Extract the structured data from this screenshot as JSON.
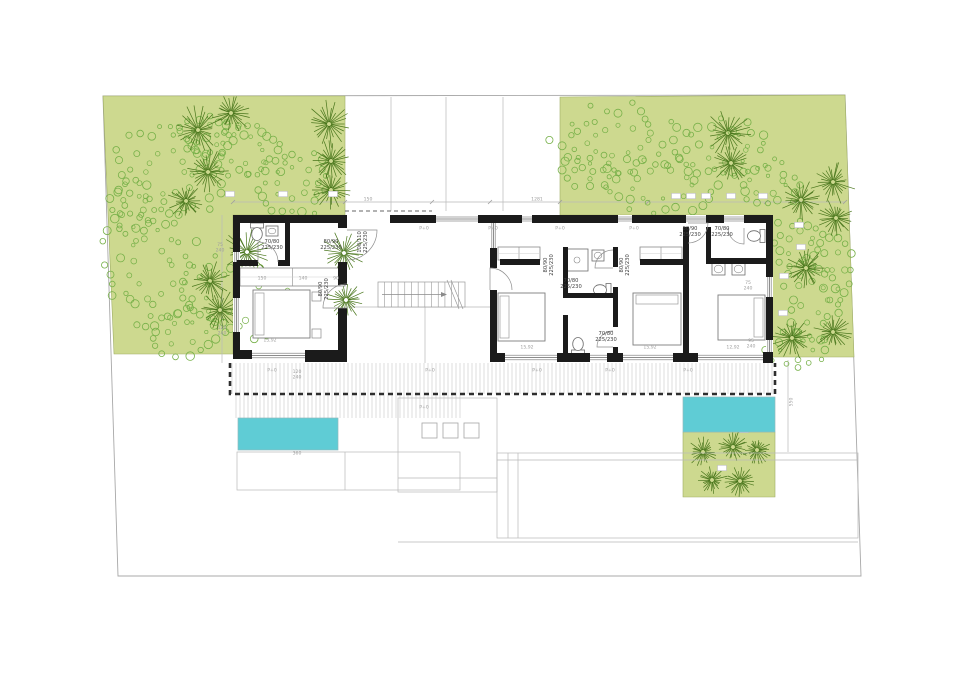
{
  "title": "villa-ground-floor-plan",
  "canvas": {
    "w": 960,
    "h": 679,
    "bg": "#ffffff"
  },
  "colors": {
    "garden": "#cdd98f",
    "shrub": "#76b048",
    "palm": "#49761c",
    "pool": "#5fccd5",
    "wall": "#1b1b1b",
    "thin": "#b9b9b9",
    "hatch": "#c6c6c6",
    "dash": "#2e2e2e",
    "furn": "#8a8a8a",
    "dim": "#9e9e9e",
    "label": "#3f3f3f",
    "boundary": "#a8a8a8"
  },
  "plan": {
    "boundary": [
      [
        103,
        96
      ],
      [
        845,
        95
      ],
      [
        861,
        576
      ],
      [
        118,
        576
      ]
    ],
    "gardens": {
      "left": [
        [
          103,
          96
        ],
        [
          345,
          96
        ],
        [
          345,
          215
        ],
        [
          233,
          215
        ],
        [
          233,
          354
        ],
        [
          114,
          354
        ]
      ],
      "right": [
        [
          560,
          97
        ],
        [
          845,
          95
        ],
        [
          854,
          357
        ],
        [
          770,
          357
        ],
        [
          770,
          215
        ],
        [
          560,
          215
        ]
      ],
      "patch": [
        [
          683,
          432
        ],
        [
          775,
          432
        ],
        [
          775,
          497
        ],
        [
          683,
          497
        ]
      ]
    },
    "pools": [
      {
        "x": 238,
        "y": 418,
        "w": 100,
        "h": 32
      },
      {
        "x": 683,
        "y": 397,
        "w": 92,
        "h": 35
      }
    ],
    "deck": {
      "strips": [
        {
          "x": 232,
          "y": 363,
          "w": 543,
          "h": 31
        },
        {
          "x": 236,
          "y": 394,
          "w": 224,
          "h": 24
        }
      ],
      "border": "M230,363 L230,394 L775,394 L775,363"
    },
    "palms": [
      [
        198,
        130,
        26
      ],
      [
        231,
        113,
        21
      ],
      [
        329,
        124,
        25
      ],
      [
        208,
        172,
        23
      ],
      [
        331,
        161,
        21
      ],
      [
        331,
        190,
        20
      ],
      [
        186,
        201,
        19
      ],
      [
        247,
        252,
        26
      ],
      [
        344,
        253,
        23
      ],
      [
        210,
        281,
        21
      ],
      [
        220,
        310,
        22
      ],
      [
        346,
        300,
        20
      ],
      [
        728,
        133,
        24
      ],
      [
        731,
        163,
        21
      ],
      [
        833,
        182,
        23
      ],
      [
        801,
        200,
        21
      ],
      [
        836,
        218,
        20
      ],
      [
        806,
        268,
        21
      ],
      [
        792,
        338,
        22
      ],
      [
        833,
        332,
        20
      ],
      [
        703,
        452,
        16
      ],
      [
        733,
        447,
        17
      ],
      [
        757,
        450,
        15
      ],
      [
        712,
        480,
        16
      ],
      [
        740,
        481,
        16
      ]
    ],
    "shrubs": [
      [
        165,
        175,
        48,
        40,
        34
      ],
      [
        243,
        150,
        40,
        26,
        26
      ],
      [
        292,
        183,
        36,
        28,
        24
      ],
      [
        210,
        135,
        30,
        18,
        16
      ],
      [
        150,
        265,
        40,
        52,
        34
      ],
      [
        235,
        298,
        52,
        36,
        30
      ],
      [
        183,
        332,
        34,
        20,
        18
      ],
      [
        130,
        210,
        22,
        26,
        14
      ],
      [
        618,
        140,
        58,
        30,
        32
      ],
      [
        728,
        150,
        40,
        26,
        22
      ],
      [
        660,
        185,
        48,
        26,
        26
      ],
      [
        768,
        185,
        30,
        20,
        16
      ],
      [
        590,
        170,
        26,
        16,
        12
      ],
      [
        800,
        243,
        26,
        24,
        16
      ],
      [
        812,
        300,
        24,
        36,
        20
      ],
      [
        798,
        350,
        26,
        18,
        12
      ],
      [
        838,
        270,
        14,
        30,
        12
      ]
    ],
    "chips": [
      [
        230,
        194
      ],
      [
        283,
        194
      ],
      [
        333,
        194
      ],
      [
        676,
        196
      ],
      [
        691,
        196
      ],
      [
        706,
        196
      ],
      [
        731,
        196
      ],
      [
        763,
        196
      ],
      [
        799,
        225
      ],
      [
        801,
        247
      ],
      [
        784,
        276
      ],
      [
        783,
        313
      ],
      [
        744,
        430
      ],
      [
        722,
        468
      ]
    ],
    "thin": [
      [
        391,
        97,
        391,
        211
      ],
      [
        446,
        97,
        446,
        211
      ],
      [
        503,
        97,
        503,
        211
      ],
      [
        233,
        202,
        845,
        202
      ],
      [
        347,
        307,
        490,
        307
      ],
      [
        425,
        307,
        425,
        363
      ],
      [
        222,
        215,
        222,
        363
      ],
      [
        788,
        360,
        788,
        452
      ]
    ],
    "dashed_thin": [
      [
        345,
        211,
        432,
        211
      ]
    ],
    "outlines": [
      {
        "x": 237,
        "y": 452,
        "w": 223,
        "h": 38
      },
      {
        "x": 398,
        "y": 398,
        "w": 99,
        "h": 94
      },
      {
        "x": 497,
        "y": 453,
        "w": 361,
        "h": 85
      }
    ],
    "outline_lines": [
      [
        345,
        452,
        345,
        490
      ],
      [
        398,
        478,
        497,
        478
      ],
      [
        497,
        460,
        858,
        460
      ],
      [
        508,
        453,
        508,
        538
      ],
      [
        518,
        453,
        518,
        538
      ],
      [
        398,
        542,
        858,
        542
      ]
    ],
    "squares": [
      [
        422,
        423,
        15,
        15
      ],
      [
        443,
        423,
        15,
        15
      ],
      [
        464,
        423,
        15,
        15
      ]
    ],
    "walls": [
      [
        233,
        215,
        112,
        8
      ],
      [
        233,
        223,
        7,
        29
      ],
      [
        233,
        262,
        7,
        36
      ],
      [
        233,
        332,
        7,
        24
      ],
      [
        233,
        350,
        19,
        9
      ],
      [
        305,
        350,
        42,
        12
      ],
      [
        338,
        215,
        9,
        13
      ],
      [
        338,
        262,
        9,
        23
      ],
      [
        338,
        308,
        9,
        42
      ],
      [
        390,
        215,
        46,
        8
      ],
      [
        478,
        215,
        44,
        8
      ],
      [
        532,
        215,
        86,
        8
      ],
      [
        632,
        215,
        54,
        8
      ],
      [
        706,
        215,
        18,
        8
      ],
      [
        744,
        215,
        29,
        8
      ],
      [
        490,
        248,
        7,
        20
      ],
      [
        490,
        290,
        7,
        63
      ],
      [
        766,
        215,
        7,
        62
      ],
      [
        766,
        297,
        7,
        43
      ],
      [
        763,
        352,
        10,
        11
      ],
      [
        490,
        353,
        15,
        9
      ],
      [
        557,
        353,
        33,
        9
      ],
      [
        607,
        353,
        16,
        9
      ],
      [
        673,
        353,
        25,
        9
      ],
      [
        563,
        247,
        5,
        50
      ],
      [
        563,
        315,
        5,
        38
      ],
      [
        613,
        247,
        5,
        20
      ],
      [
        613,
        287,
        5,
        40
      ],
      [
        613,
        347,
        5,
        6
      ],
      [
        563,
        293,
        55,
        5
      ],
      [
        683,
        227,
        6,
        126
      ],
      [
        706,
        258,
        60,
        6
      ],
      [
        706,
        227,
        5,
        31
      ],
      [
        500,
        259,
        40,
        6
      ],
      [
        640,
        259,
        43,
        6
      ],
      [
        237,
        260,
        21,
        6
      ],
      [
        278,
        260,
        12,
        6
      ],
      [
        285,
        222,
        5,
        38
      ]
    ],
    "windows": [
      {
        "x": 233,
        "y": 252,
        "w": 7,
        "h": 10,
        "o": "v"
      },
      {
        "x": 233,
        "y": 298,
        "w": 7,
        "h": 34,
        "o": "v"
      },
      {
        "x": 490,
        "y": 223,
        "w": 7,
        "h": 25,
        "o": "v"
      },
      {
        "x": 766,
        "y": 277,
        "w": 7,
        "h": 20,
        "o": "v"
      },
      {
        "x": 766,
        "y": 340,
        "w": 7,
        "h": 12,
        "o": "v"
      },
      {
        "x": 436,
        "y": 215,
        "w": 42,
        "h": 8,
        "o": "h"
      },
      {
        "x": 522,
        "y": 215,
        "w": 10,
        "h": 8,
        "o": "h"
      },
      {
        "x": 618,
        "y": 215,
        "w": 14,
        "h": 8,
        "o": "h"
      },
      {
        "x": 686,
        "y": 215,
        "w": 20,
        "h": 8,
        "o": "h"
      },
      {
        "x": 724,
        "y": 215,
        "w": 20,
        "h": 8,
        "o": "h"
      },
      {
        "x": 505,
        "y": 353,
        "w": 52,
        "h": 9,
        "o": "h"
      },
      {
        "x": 590,
        "y": 353,
        "w": 17,
        "h": 9,
        "o": "h"
      },
      {
        "x": 623,
        "y": 353,
        "w": 50,
        "h": 9,
        "o": "h"
      },
      {
        "x": 698,
        "y": 353,
        "w": 65,
        "h": 9,
        "o": "h"
      },
      {
        "x": 252,
        "y": 351,
        "w": 55,
        "h": 9,
        "o": "h"
      }
    ],
    "arcs": [
      [
        347,
        230,
        30,
        0,
        90
      ],
      [
        258,
        262,
        20,
        270,
        360
      ],
      [
        347,
        308,
        24,
        180,
        270
      ],
      [
        490,
        290,
        22,
        270,
        360
      ],
      [
        613,
        268,
        18,
        180,
        270
      ],
      [
        613,
        347,
        16,
        180,
        270
      ],
      [
        688,
        223,
        20,
        0,
        90
      ],
      [
        744,
        228,
        16,
        90,
        180
      ]
    ],
    "stairs": {
      "x": 378,
      "y": 282,
      "w": 87,
      "h": 25,
      "treads": 13
    },
    "beds": [
      {
        "x": 253,
        "y": 290,
        "w": 57,
        "h": 48,
        "p": "w"
      },
      {
        "x": 498,
        "y": 293,
        "w": 47,
        "h": 48,
        "p": "w"
      },
      {
        "x": 633,
        "y": 293,
        "w": 48,
        "h": 52,
        "p": "n"
      },
      {
        "x": 718,
        "y": 295,
        "w": 47,
        "h": 45,
        "p": "e"
      }
    ],
    "wardrobes": [
      {
        "x": 498,
        "y": 247,
        "w": 42,
        "h": 13
      },
      {
        "x": 640,
        "y": 247,
        "w": 42,
        "h": 13
      },
      {
        "x": 240,
        "y": 268,
        "w": 105,
        "h": 18
      }
    ],
    "nightstands": [
      [
        312,
        292,
        9,
        9
      ],
      [
        312,
        329,
        9,
        9
      ]
    ],
    "toilets": [
      [
        257,
        234,
        0
      ],
      [
        600,
        290,
        90
      ],
      [
        578,
        344,
        180
      ],
      [
        754,
        236,
        90
      ]
    ],
    "sinks": [
      [
        712,
        263,
        13,
        12
      ],
      [
        732,
        263,
        13,
        12
      ],
      [
        592,
        250,
        12,
        11
      ],
      [
        266,
        226,
        12,
        10
      ]
    ],
    "shower": [
      566,
      249,
      22,
      22
    ],
    "dim_ticks": [
      233,
      345,
      432,
      490,
      560,
      648,
      766,
      845
    ],
    "texts": [
      {
        "s": [
          "70/80",
          "225/230"
        ],
        "x": 272,
        "y": 244,
        "c": "label"
      },
      {
        "s": [
          "80/90",
          "225/230"
        ],
        "x": 331,
        "y": 244,
        "c": "label"
      },
      {
        "s": [
          "100/110",
          "225/230"
        ],
        "x": 362,
        "y": 242,
        "c": "label",
        "r": -90
      },
      {
        "s": [
          "80/90",
          "225/230"
        ],
        "x": 323,
        "y": 289,
        "c": "label",
        "r": -90
      },
      {
        "s": [
          "80/90",
          "225/230"
        ],
        "x": 548,
        "y": 265,
        "c": "label",
        "r": -90
      },
      {
        "s": [
          "70/80",
          "225/230"
        ],
        "x": 571,
        "y": 283,
        "c": "label"
      },
      {
        "s": [
          "80/90",
          "225/230"
        ],
        "x": 624,
        "y": 265,
        "c": "label",
        "r": -90
      },
      {
        "s": [
          "70/80",
          "225/230"
        ],
        "x": 606,
        "y": 336,
        "c": "label"
      },
      {
        "s": [
          "80/90",
          "225/230"
        ],
        "x": 690,
        "y": 231,
        "c": "label"
      },
      {
        "s": [
          "70/80",
          "225/230"
        ],
        "x": 722,
        "y": 231,
        "c": "label"
      },
      {
        "s": [
          "150"
        ],
        "x": 368,
        "y": 199,
        "c": "dim"
      },
      {
        "s": [
          "1281"
        ],
        "x": 537,
        "y": 199,
        "c": "dim"
      },
      {
        "s": [
          "75",
          "240"
        ],
        "x": 220,
        "y": 247,
        "c": "dim"
      },
      {
        "s": [
          "120",
          "240"
        ],
        "x": 222,
        "y": 330,
        "c": "dim"
      },
      {
        "s": [
          "120",
          "240"
        ],
        "x": 297,
        "y": 374,
        "c": "dim"
      },
      {
        "s": [
          "75",
          "240"
        ],
        "x": 748,
        "y": 285,
        "c": "dim"
      },
      {
        "s": [
          "95",
          "240"
        ],
        "x": 751,
        "y": 343,
        "c": "dim"
      },
      {
        "s": [
          "360"
        ],
        "x": 297,
        "y": 453,
        "c": "dim"
      },
      {
        "s": [
          "550"
        ],
        "x": 791,
        "y": 402,
        "c": "dim",
        "r": -90
      },
      {
        "s": [
          "15,92"
        ],
        "x": 527,
        "y": 347,
        "c": "dim"
      },
      {
        "s": [
          "15,92"
        ],
        "x": 650,
        "y": 347,
        "c": "dim"
      },
      {
        "s": [
          "12,92"
        ],
        "x": 733,
        "y": 347,
        "c": "dim"
      },
      {
        "s": [
          "15,92"
        ],
        "x": 270,
        "y": 340,
        "c": "dim"
      },
      {
        "s": [
          "150"
        ],
        "x": 262,
        "y": 278,
        "c": "dim"
      },
      {
        "s": [
          "140"
        ],
        "x": 303,
        "y": 278,
        "c": "dim"
      },
      {
        "s": [
          "90"
        ],
        "x": 336,
        "y": 278,
        "c": "dim"
      },
      {
        "s": [
          "P+0"
        ],
        "x": 424,
        "y": 228,
        "c": "dim"
      },
      {
        "s": [
          "P+0"
        ],
        "x": 493,
        "y": 228,
        "c": "dim"
      },
      {
        "s": [
          "P+0"
        ],
        "x": 560,
        "y": 228,
        "c": "dim"
      },
      {
        "s": [
          "P+0"
        ],
        "x": 634,
        "y": 228,
        "c": "dim"
      },
      {
        "s": [
          "P+0"
        ],
        "x": 272,
        "y": 370,
        "c": "dim"
      },
      {
        "s": [
          "P+0"
        ],
        "x": 430,
        "y": 370,
        "c": "dim"
      },
      {
        "s": [
          "P+0"
        ],
        "x": 537,
        "y": 370,
        "c": "dim"
      },
      {
        "s": [
          "P+0"
        ],
        "x": 610,
        "y": 370,
        "c": "dim"
      },
      {
        "s": [
          "P+0"
        ],
        "x": 688,
        "y": 370,
        "c": "dim"
      },
      {
        "s": [
          "P+0"
        ],
        "x": 424,
        "y": 407,
        "c": "dim"
      }
    ]
  }
}
